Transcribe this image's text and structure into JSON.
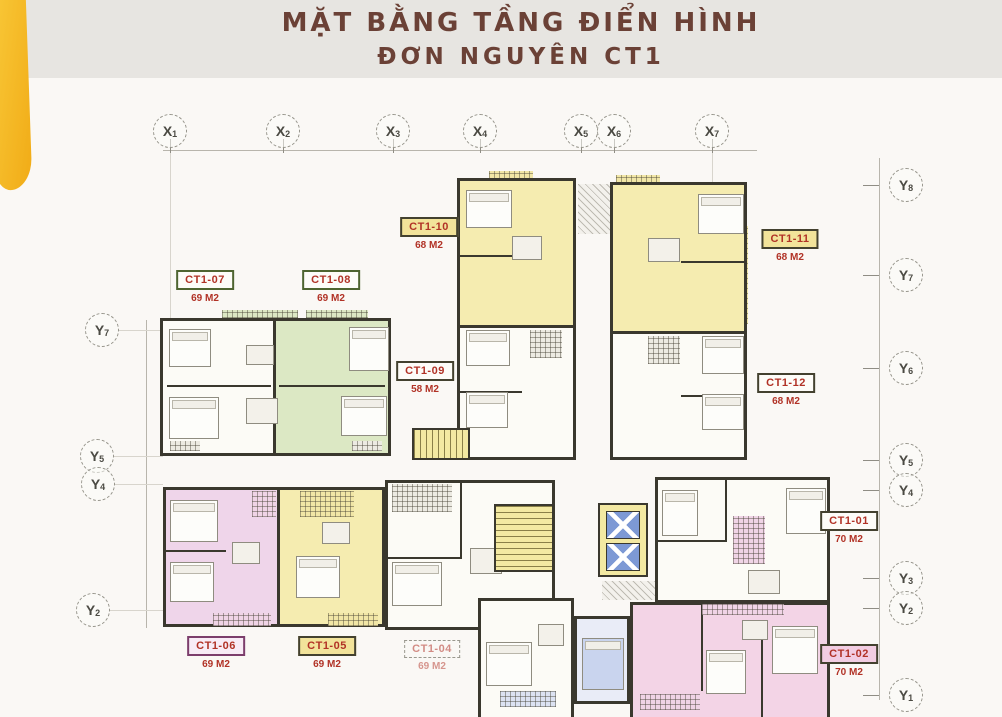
{
  "title": {
    "line1": "MẶT BẰNG TẦNG ĐIỂN HÌNH",
    "line2": "ĐƠN NGUYÊN CT1"
  },
  "grid": {
    "x_top": [
      {
        "label": "X",
        "sub": "1"
      },
      {
        "label": "X",
        "sub": "2"
      },
      {
        "label": "X",
        "sub": "3"
      },
      {
        "label": "X",
        "sub": "4"
      },
      {
        "label": "X",
        "sub": "5"
      },
      {
        "label": "X",
        "sub": "6"
      },
      {
        "label": "X",
        "sub": "7"
      }
    ],
    "y_left": [
      {
        "label": "Y",
        "sub": "7"
      },
      {
        "label": "Y",
        "sub": "5"
      },
      {
        "label": "Y",
        "sub": "4"
      },
      {
        "label": "Y",
        "sub": "2"
      }
    ],
    "y_right": [
      {
        "label": "Y",
        "sub": "8"
      },
      {
        "label": "Y",
        "sub": "7"
      },
      {
        "label": "Y",
        "sub": "6"
      },
      {
        "label": "Y",
        "sub": "5"
      },
      {
        "label": "Y",
        "sub": "4"
      },
      {
        "label": "Y",
        "sub": "3"
      },
      {
        "label": "Y",
        "sub": "2"
      },
      {
        "label": "Y",
        "sub": "1"
      }
    ]
  },
  "apartments": [
    {
      "id": "CT1-07",
      "area": "69 M2"
    },
    {
      "id": "CT1-08",
      "area": "69 M2"
    },
    {
      "id": "CT1-10",
      "area": "68 M2"
    },
    {
      "id": "CT1-09",
      "area": "58 M2"
    },
    {
      "id": "CT1-11",
      "area": "68 M2"
    },
    {
      "id": "CT1-12",
      "area": "68 M2"
    },
    {
      "id": "CT1-01",
      "area": "70 M2"
    },
    {
      "id": "CT1-02",
      "area": "70 M2"
    },
    {
      "id": "CT1-06",
      "area": "69 M2"
    },
    {
      "id": "CT1-05",
      "area": "69 M2"
    },
    {
      "id": "CT1-04",
      "area": "69 M2"
    }
  ],
  "colors": {
    "title_text": "#6b4136",
    "label_text": "#b13226",
    "apartment_green": "#dce8c4",
    "apartment_yellow": "#f5ecb0",
    "apartment_pink": "#efd5ea",
    "apartment_pink_bottom": "#f3d4e6",
    "apartment_white": "#fcfbf6",
    "elevator_blue": "#7d99d5",
    "stair_core_yellow": "#f3e9a2",
    "wall": "#3a382e",
    "accent_shape_yellow": "#f6bd27",
    "top_band_gray": "#e7e5e1"
  }
}
